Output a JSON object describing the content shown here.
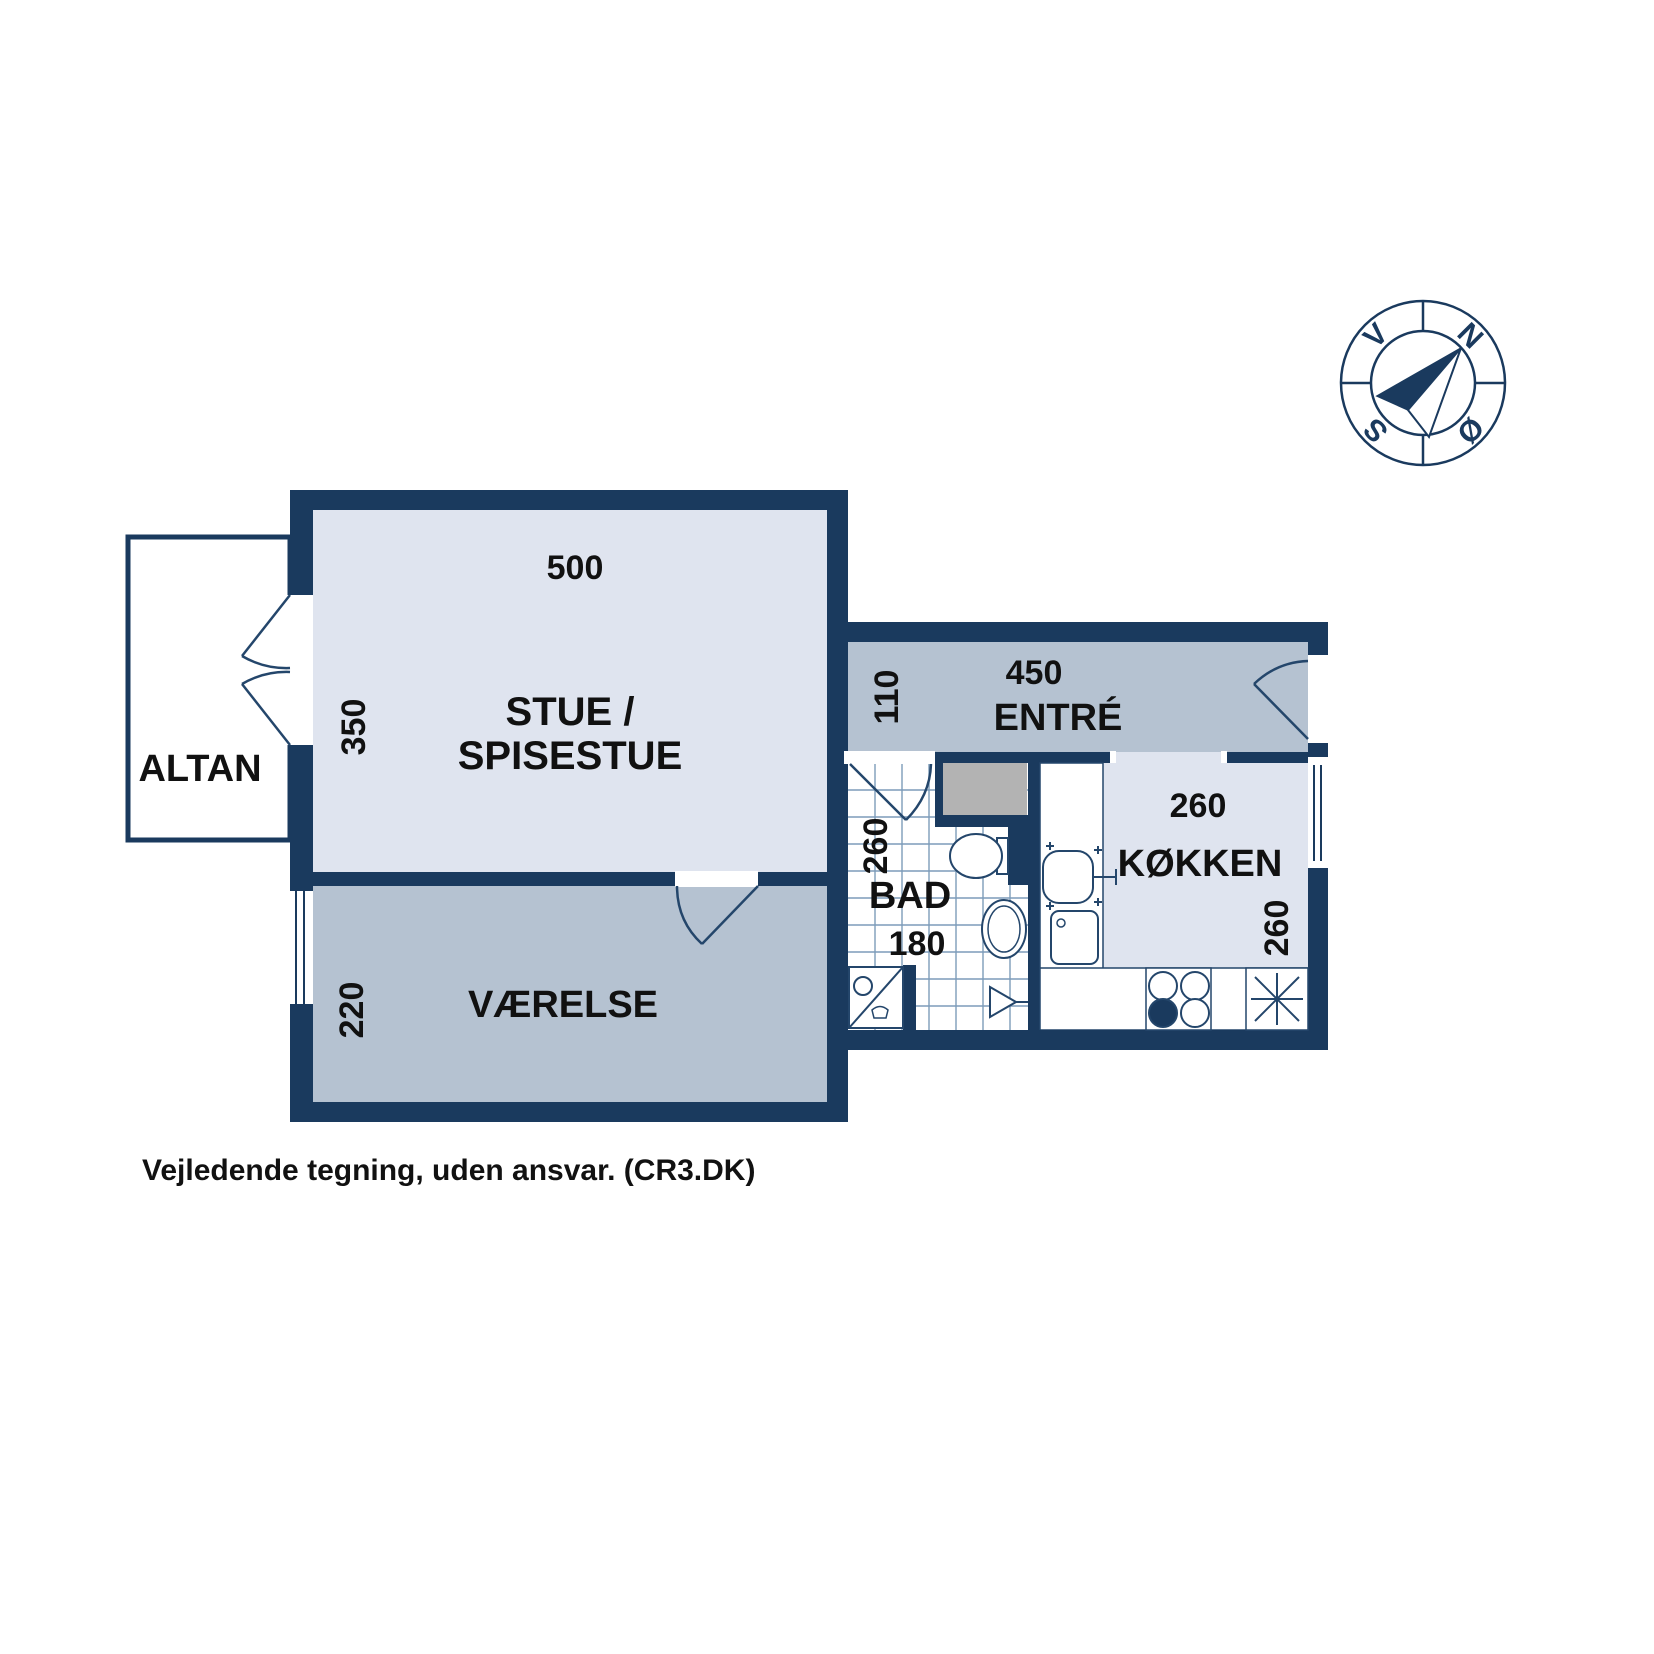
{
  "floorplan": {
    "footer_note": "Vejledende tegning, uden ansvar. (CR3.DK)",
    "rooms": {
      "stue": {
        "label_line1": "STUE /",
        "label_line2": "SPISESTUE",
        "width_cm": "500",
        "height_cm": "350"
      },
      "vaerelse": {
        "label": "VÆRELSE",
        "height_cm": "220"
      },
      "altan": {
        "label": "ALTAN"
      },
      "entre": {
        "label": "ENTRÉ",
        "width_cm": "450",
        "height_cm": "110"
      },
      "bad": {
        "label": "BAD",
        "width_cm": "180",
        "height_cm": "260"
      },
      "kokken": {
        "label": "KØKKEN",
        "width_cm": "260",
        "height_cm": "260"
      }
    },
    "compass": {
      "north": "N",
      "east": "Ø",
      "south": "S",
      "west": "V"
    },
    "colors": {
      "wall": "#1a3a5e",
      "room_light": "#dfe4ef",
      "room_medium": "#b5c2d1",
      "closet_grey": "#b3b3b3",
      "fixture_stroke": "#24466b",
      "tile_line": "#7d9cba",
      "text": "#111111"
    }
  }
}
